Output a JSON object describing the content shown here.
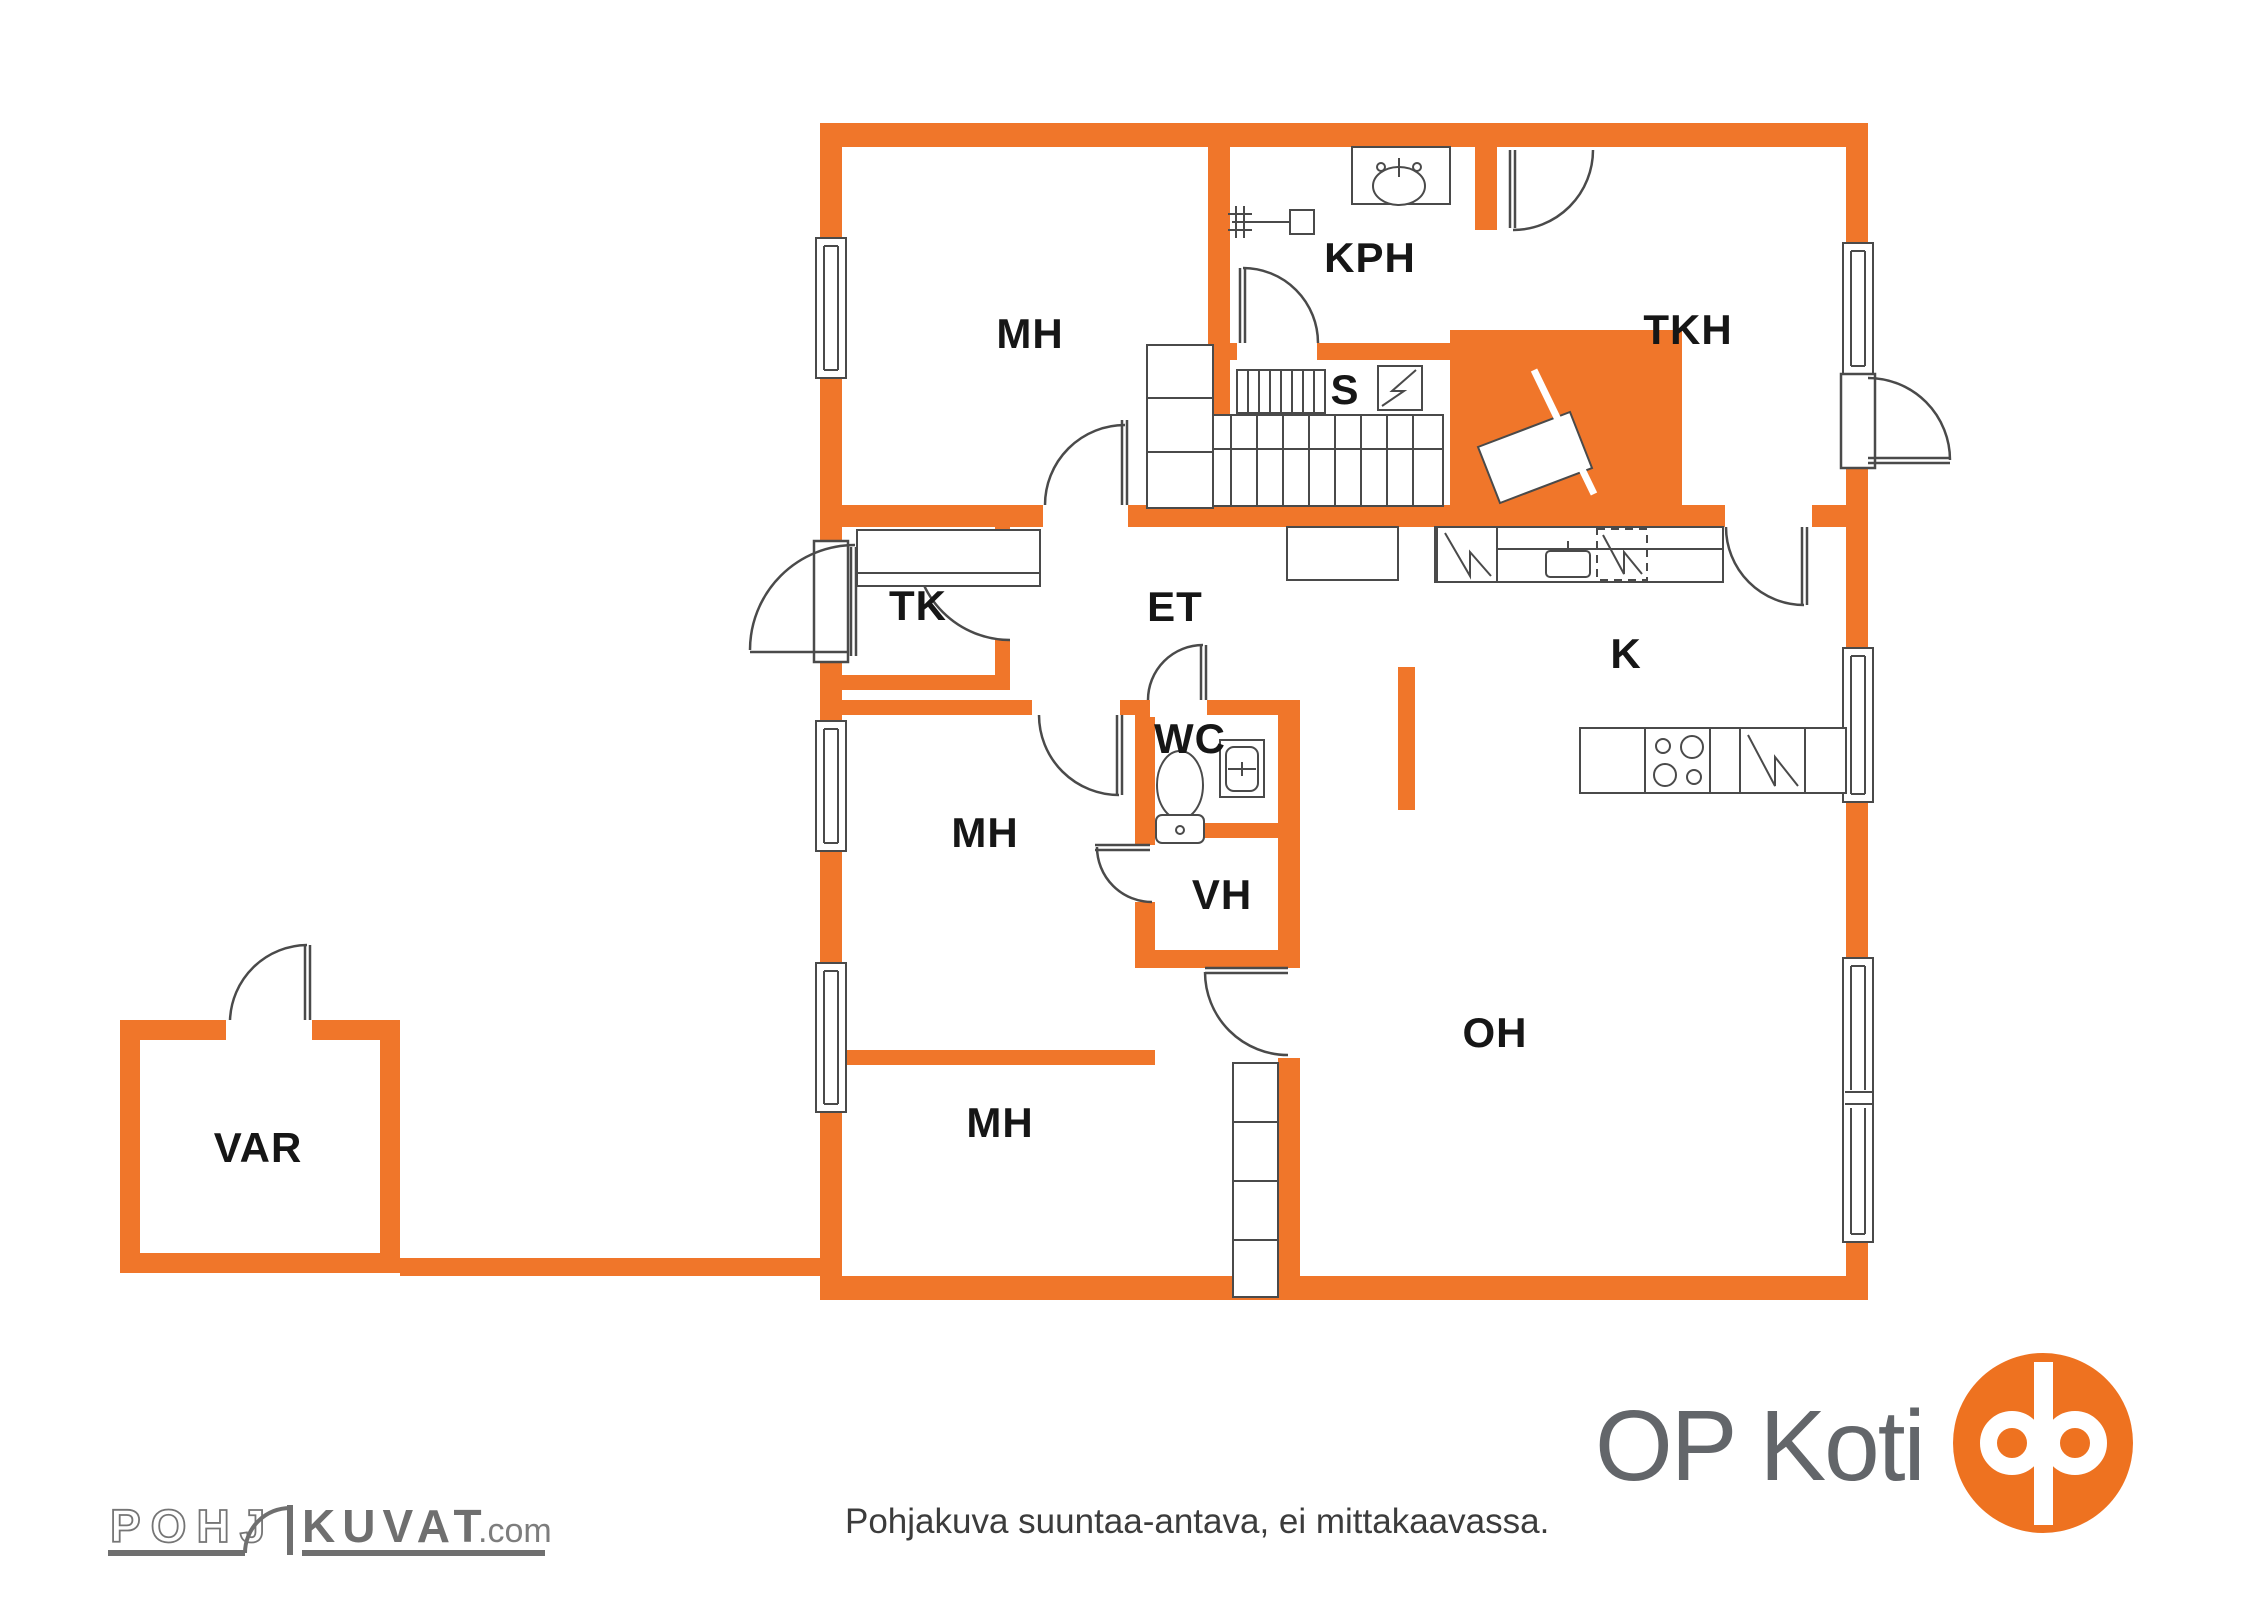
{
  "colors": {
    "wall_orange": "#F0762A",
    "fixture_line": "#4a4a4a",
    "label_black": "#161616",
    "logo_gray": "#63666a",
    "op_orange": "#EE7220"
  },
  "rooms": {
    "mh_top": {
      "label": "MH"
    },
    "kph": {
      "label": "KPH"
    },
    "tkh": {
      "label": "TKH"
    },
    "s": {
      "label": "S"
    },
    "tk": {
      "label": "TK"
    },
    "et": {
      "label": "ET"
    },
    "k": {
      "label": "K"
    },
    "wc": {
      "label": "WC"
    },
    "mh_mid": {
      "label": "MH"
    },
    "vh": {
      "label": "VH"
    },
    "mh_bottom": {
      "label": "MH"
    },
    "oh": {
      "label": "OH"
    },
    "var": {
      "label": "VAR"
    }
  },
  "footer": {
    "disclaimer": "Pohjakuva suuntaa-antava, ei mittakaavassa.",
    "brand_left_part1": "POHJ",
    "brand_left_part2": "KUVAT",
    "brand_left_suffix": ".com",
    "brand_right": "OP Koti"
  }
}
